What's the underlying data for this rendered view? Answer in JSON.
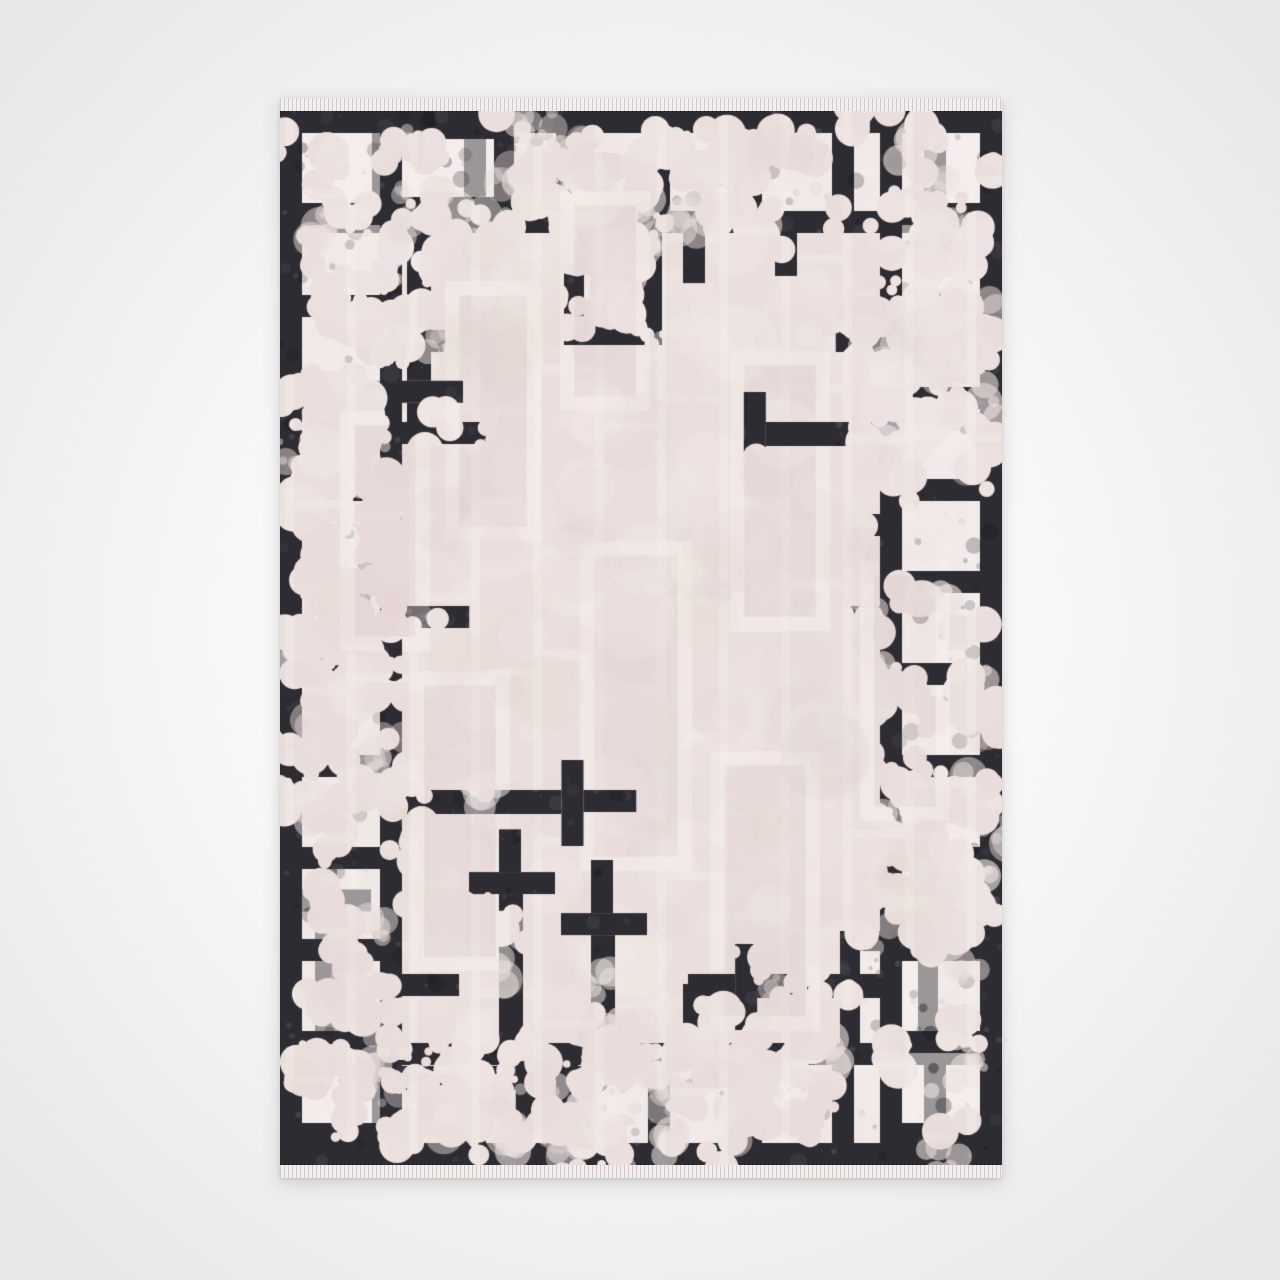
{
  "meta": {
    "alt": "Product photo of a rectangular area rug with a distressed charcoal art-deco fret border and a pale blush-beige field patterned with tone-on-tone rectangles, photographed flat on a light gray studio background with small fringe at the top and bottom edges"
  },
  "scene": {
    "background": {
      "center": "#ffffff",
      "mid": "#f5f5f5",
      "edge": "#e9e9e9",
      "corner": "#e7e7e7"
    }
  },
  "rug": {
    "seed": 11,
    "position": {
      "x": 280,
      "y": 98,
      "width": 722,
      "pile_height": 1054,
      "fringe_height": 13
    },
    "colors": {
      "border_dark": "#2d2c32",
      "border_speckle_light": "#4a4952",
      "border_speckle_dark": "#1a191f",
      "border_fleck": "#8a8a92",
      "cell_light": "#f6f0ee",
      "field": "#ebdfdd",
      "field_shade": "#e2d3d1",
      "field_light": "#f7f1ef",
      "motif_line": "#f2eae6",
      "fringe_light": "#f3efee",
      "fringe_dark": "#cfc7c6"
    },
    "field_pattern": {
      "col_period": 62,
      "col_offset": 5,
      "line_w": 9,
      "brick_min": 75,
      "brick_max": 195,
      "mottle_count": 430,
      "grain_count": 2600,
      "motifs": [
        {
          "x": 300,
          "y": 430,
          "w": 112,
          "h": 330
        },
        {
          "x": 165,
          "y": 170,
          "w": 96,
          "h": 260
        },
        {
          "x": 450,
          "y": 240,
          "w": 100,
          "h": 280
        },
        {
          "x": 130,
          "y": 560,
          "w": 100,
          "h": 300
        },
        {
          "x": 430,
          "y": 640,
          "w": 110,
          "h": 280
        },
        {
          "x": 280,
          "y": 80,
          "w": 90,
          "h": 220
        },
        {
          "x": 580,
          "y": 450,
          "w": 90,
          "h": 260
        },
        {
          "x": 60,
          "y": 300,
          "w": 90,
          "h": 240
        }
      ]
    },
    "fret": {
      "period": 92,
      "band": 22,
      "wall": 22,
      "cell_h": 78,
      "speckle_count": 700,
      "fleck_count": 400
    },
    "erosion": {
      "base": 0.14,
      "ring_depth": 270,
      "attempts": 1600,
      "zones": [
        {
          "cx": 330,
          "cy": 70,
          "rx": 95,
          "ry": 80,
          "s": 1.0
        },
        {
          "cx": 185,
          "cy": 155,
          "rx": 75,
          "ry": 65,
          "s": 0.55
        },
        {
          "cx": 480,
          "cy": 65,
          "rx": 55,
          "ry": 45,
          "s": 0.5
        },
        {
          "cx": 585,
          "cy": 95,
          "rx": 60,
          "ry": 55,
          "s": 0.5
        },
        {
          "cx": 660,
          "cy": 160,
          "rx": 60,
          "ry": 85,
          "s": 0.5
        },
        {
          "cx": 45,
          "cy": 400,
          "rx": 85,
          "ry": 175,
          "s": 1.05
        },
        {
          "cx": 60,
          "cy": 645,
          "rx": 70,
          "ry": 95,
          "s": 0.6
        },
        {
          "cx": 55,
          "cy": 930,
          "rx": 65,
          "ry": 80,
          "s": 0.55
        },
        {
          "cx": 165,
          "cy": 1000,
          "rx": 60,
          "ry": 55,
          "s": 0.6
        },
        {
          "cx": 350,
          "cy": 1005,
          "rx": 100,
          "ry": 75,
          "s": 1.0
        },
        {
          "cx": 505,
          "cy": 985,
          "rx": 55,
          "ry": 50,
          "s": 0.45
        },
        {
          "cx": 680,
          "cy": 300,
          "rx": 70,
          "ry": 95,
          "s": 0.55
        },
        {
          "cx": 665,
          "cy": 730,
          "rx": 85,
          "ry": 150,
          "s": 0.9
        }
      ]
    }
  }
}
